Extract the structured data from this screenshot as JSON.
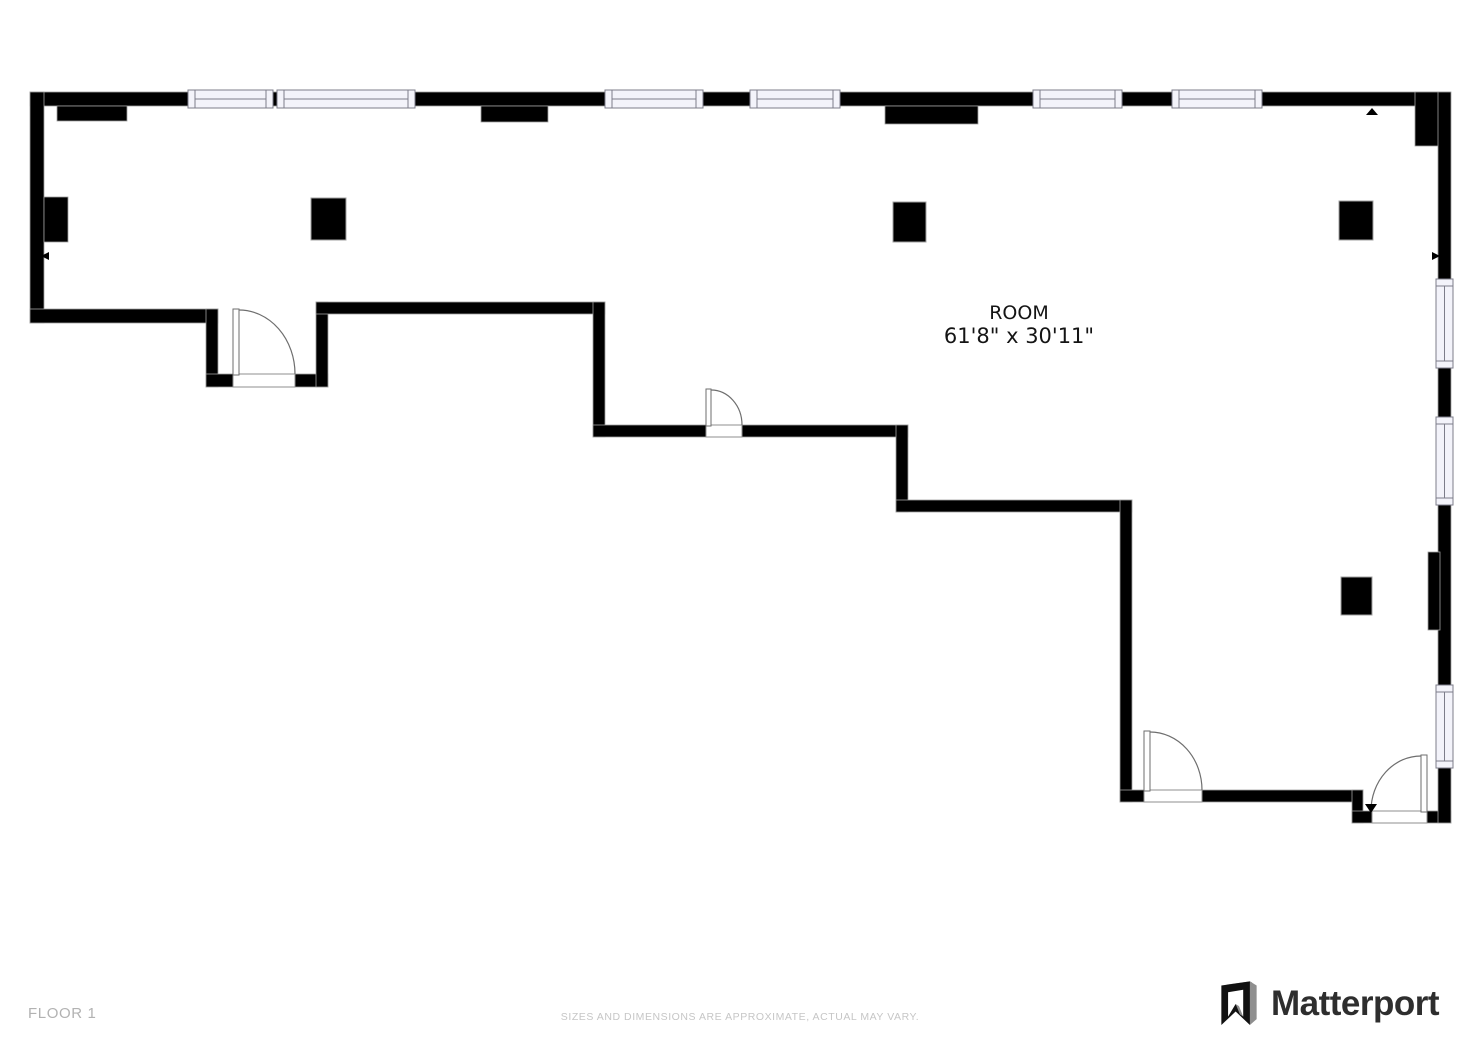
{
  "room": {
    "name": "ROOM",
    "dimensions": "61'8\" x 30'11\""
  },
  "footer": {
    "floor_label": "FLOOR 1",
    "disclaimer": "SIZES AND DIMENSIONS ARE APPROXIMATE, ACTUAL MAY VARY."
  },
  "brand": {
    "name": "Matterport",
    "icon": "matterport-logo-icon"
  },
  "plan": {
    "type": "floorplan",
    "features": {
      "windows_top": 6,
      "windows_right": 3,
      "doors": 4,
      "columns": 4
    }
  },
  "colors": {
    "wall": "#000000",
    "outline": "#a0a0a0",
    "window_fill": "#f3f3fa",
    "window_border": "#7d7d8a",
    "door_line": "#6e6e6e",
    "room_text": "#141414",
    "floor_label": "#b2b2b2",
    "disclaimer": "#c6c6c6",
    "brand_text": "#2e2e2e",
    "brand_gray": "#8f8f8f"
  }
}
